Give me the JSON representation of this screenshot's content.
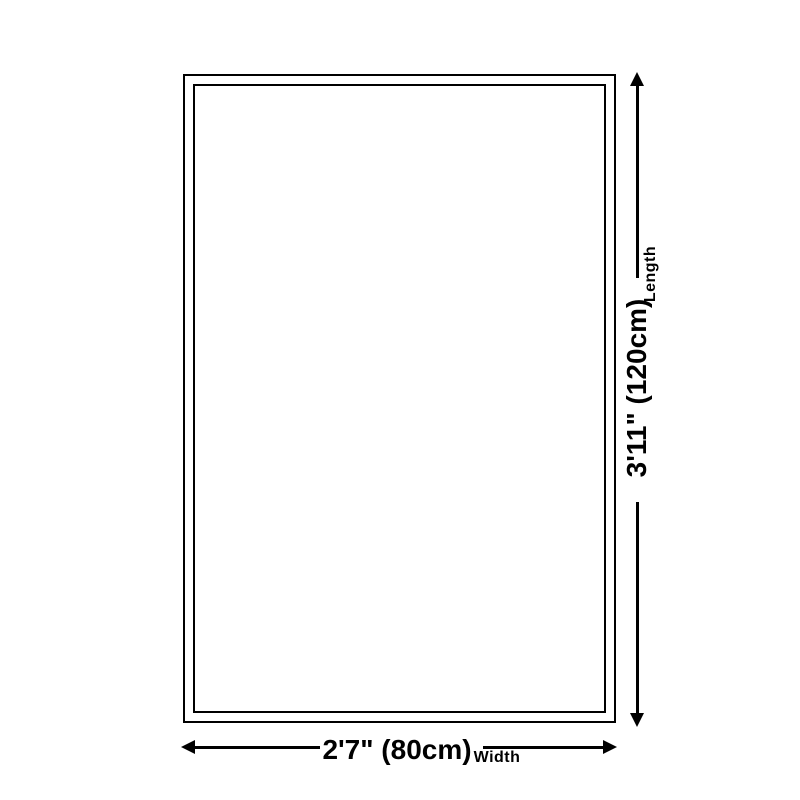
{
  "page": {
    "background_color": "#ffffff",
    "line_color": "#000000",
    "description": "Product size dimension diagram"
  },
  "diagram": {
    "length": {
      "value_label": "3'11\" (120cm)",
      "axis_label": "Length"
    },
    "width": {
      "value_label": "2'7\" (80cm)",
      "axis_label": "Width"
    }
  }
}
